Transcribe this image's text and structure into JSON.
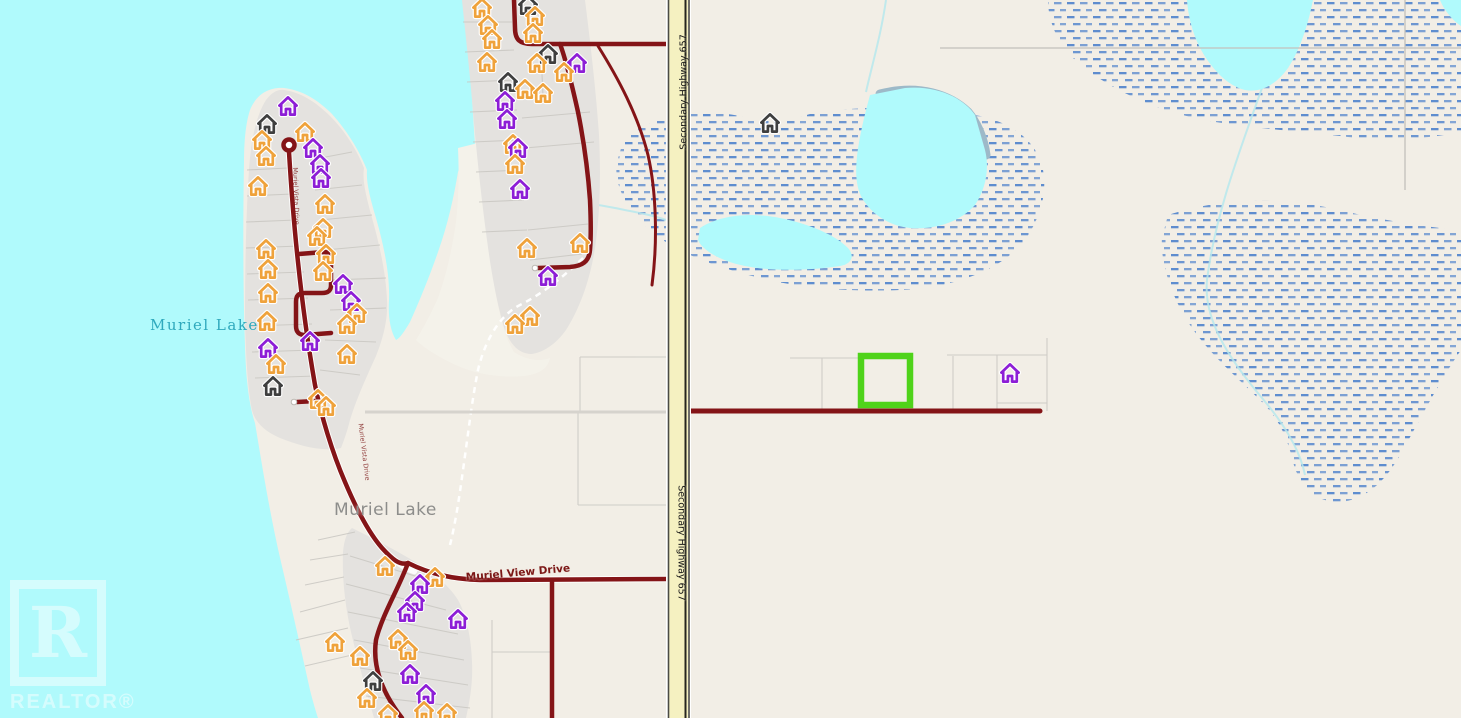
{
  "map_labels": {
    "lake_name": "Muriel Lake",
    "locality_name": "Muriel Lake",
    "highway_name": "Secondary Highway 657",
    "road_name": "Muriel View Drive",
    "small_road_name": "Muriel Vista Drive"
  },
  "watermark": {
    "logo_letter": "R",
    "brand": "REALTOR®"
  },
  "selection": {
    "stroke": "#4fd31a"
  },
  "theme_colors": {
    "water": "#b0fafc",
    "land": "#f2eee6",
    "subdivision_fill": "#e4e2df",
    "road_red": "#841417",
    "highway_fill": "#f5f1c1",
    "marsh_dash": "#4e82cc",
    "selection_green": "#4fd31a"
  },
  "house_colors": {
    "o": "#efa23b",
    "p": "#8d1ed6",
    "k": "#3f3f3f"
  },
  "houses": [
    [
      288,
      107,
      "p"
    ],
    [
      267,
      125,
      "k"
    ],
    [
      262,
      141,
      "o"
    ],
    [
      266,
      157,
      "o"
    ],
    [
      305,
      133,
      "o"
    ],
    [
      313,
      149,
      "p"
    ],
    [
      320,
      165,
      "p"
    ],
    [
      321,
      179,
      "p"
    ],
    [
      258,
      187,
      "o"
    ],
    [
      325,
      205,
      "o"
    ],
    [
      323,
      229,
      "o"
    ],
    [
      317,
      237,
      "o"
    ],
    [
      266,
      250,
      "o"
    ],
    [
      326,
      255,
      "o"
    ],
    [
      268,
      270,
      "o"
    ],
    [
      323,
      272,
      "o"
    ],
    [
      268,
      294,
      "o"
    ],
    [
      343,
      285,
      "p"
    ],
    [
      351,
      302,
      "p"
    ],
    [
      357,
      314,
      "o"
    ],
    [
      347,
      325,
      "o"
    ],
    [
      267,
      322,
      "o"
    ],
    [
      310,
      342,
      "p"
    ],
    [
      268,
      349,
      "p"
    ],
    [
      347,
      355,
      "o"
    ],
    [
      276,
      365,
      "o"
    ],
    [
      273,
      387,
      "k"
    ],
    [
      318,
      400,
      "o"
    ],
    [
      326,
      407,
      "o"
    ],
    [
      482,
      9,
      "o"
    ],
    [
      488,
      26,
      "o"
    ],
    [
      492,
      40,
      "o"
    ],
    [
      487,
      63,
      "o"
    ],
    [
      528,
      6,
      "k"
    ],
    [
      535,
      17,
      "o"
    ],
    [
      533,
      34,
      "o"
    ],
    [
      548,
      55,
      "k"
    ],
    [
      537,
      64,
      "o"
    ],
    [
      577,
      64,
      "p"
    ],
    [
      564,
      73,
      "o"
    ],
    [
      508,
      83,
      "k"
    ],
    [
      525,
      90,
      "o"
    ],
    [
      543,
      94,
      "o"
    ],
    [
      505,
      102,
      "p"
    ],
    [
      507,
      120,
      "p"
    ],
    [
      513,
      145,
      "o"
    ],
    [
      518,
      149,
      "p"
    ],
    [
      515,
      165,
      "o"
    ],
    [
      520,
      190,
      "p"
    ],
    [
      548,
      277,
      "p"
    ],
    [
      527,
      249,
      "o"
    ],
    [
      580,
      244,
      "o"
    ],
    [
      530,
      317,
      "o"
    ],
    [
      515,
      325,
      "o"
    ],
    [
      770,
      124,
      "k"
    ],
    [
      1010,
      374,
      "p"
    ],
    [
      458,
      620,
      "p"
    ],
    [
      385,
      567,
      "o"
    ],
    [
      435,
      578,
      "o"
    ],
    [
      420,
      585,
      "p"
    ],
    [
      415,
      602,
      "p"
    ],
    [
      407,
      613,
      "p"
    ],
    [
      398,
      640,
      "o"
    ],
    [
      408,
      651,
      "o"
    ],
    [
      335,
      643,
      "o"
    ],
    [
      360,
      657,
      "o"
    ],
    [
      373,
      682,
      "k"
    ],
    [
      410,
      675,
      "p"
    ],
    [
      426,
      695,
      "p"
    ],
    [
      367,
      699,
      "o"
    ],
    [
      388,
      715,
      "o"
    ],
    [
      424,
      712,
      "o"
    ],
    [
      447,
      714,
      "o"
    ]
  ]
}
